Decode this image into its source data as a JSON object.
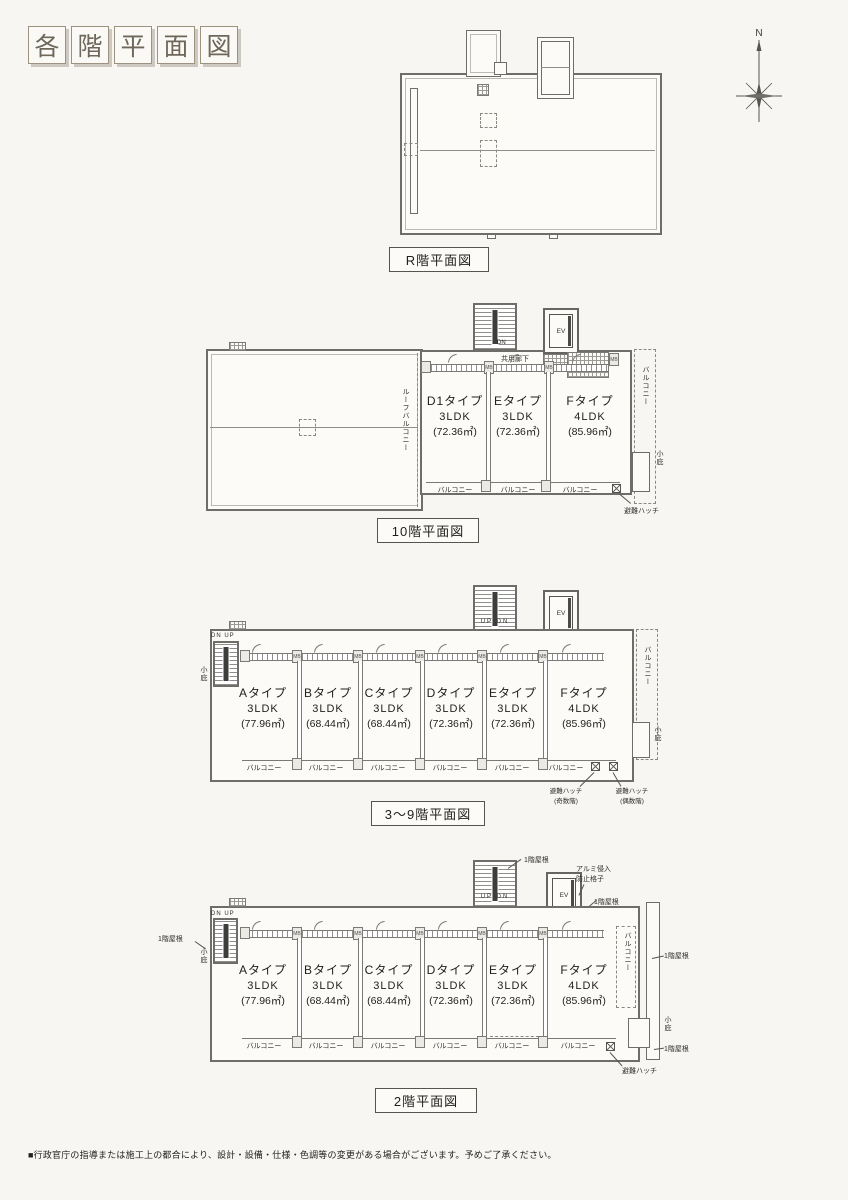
{
  "page": {
    "title_chars": [
      "各",
      "階",
      "平",
      "面",
      "図"
    ],
    "compass": "N",
    "disclaimer": "■行政官庁の指導または施工上の都合により、設計・設備・仕様・色調等の変更がある場合がございます。予めご了承ください。"
  },
  "labels": {
    "corridor": "共用廊下",
    "balcony": "バルコニー",
    "roof_balcony": "ルーフバルコニー",
    "eave": "小庇",
    "escape_hatch": "避難ハッチ",
    "floor_odd_note": "(奇数階)",
    "floor_even_note": "(偶数階)",
    "first_floor_roof": "1階屋根",
    "alumi_grate_line1": "アルミ侵入",
    "alumi_grate_line2": "防止格子",
    "elevator": "EV",
    "dn": "DN",
    "up_dn": "UP DN",
    "dn_up": "DN UP",
    "meter_box": "MB"
  },
  "plans": {
    "roof": {
      "caption": "R階平面図"
    },
    "f10": {
      "caption": "10階平面図",
      "units": [
        {
          "name": "D1タイプ",
          "layout": "3LDK",
          "area": "(72.36㎡)"
        },
        {
          "name": "Eタイプ",
          "layout": "3LDK",
          "area": "(72.36㎡)"
        },
        {
          "name": "Fタイプ",
          "layout": "4LDK",
          "area": "(85.96㎡)"
        }
      ]
    },
    "f3_9": {
      "caption": "3〜9階平面図",
      "units": [
        {
          "name": "Aタイプ",
          "layout": "3LDK",
          "area": "(77.96㎡)"
        },
        {
          "name": "Bタイプ",
          "layout": "3LDK",
          "area": "(68.44㎡)"
        },
        {
          "name": "Cタイプ",
          "layout": "3LDK",
          "area": "(68.44㎡)"
        },
        {
          "name": "Dタイプ",
          "layout": "3LDK",
          "area": "(72.36㎡)"
        },
        {
          "name": "Eタイプ",
          "layout": "3LDK",
          "area": "(72.36㎡)"
        },
        {
          "name": "Fタイプ",
          "layout": "4LDK",
          "area": "(85.96㎡)"
        }
      ]
    },
    "f2": {
      "caption": "2階平面図",
      "units": [
        {
          "name": "Aタイプ",
          "layout": "3LDK",
          "area": "(77.96㎡)"
        },
        {
          "name": "Bタイプ",
          "layout": "3LDK",
          "area": "(68.44㎡)"
        },
        {
          "name": "Cタイプ",
          "layout": "3LDK",
          "area": "(68.44㎡)"
        },
        {
          "name": "Dタイプ",
          "layout": "3LDK",
          "area": "(72.36㎡)"
        },
        {
          "name": "Eタイプ",
          "layout": "3LDK",
          "area": "(72.36㎡)"
        },
        {
          "name": "Fタイプ",
          "layout": "4LDK",
          "area": "(85.96㎡)"
        }
      ]
    }
  }
}
